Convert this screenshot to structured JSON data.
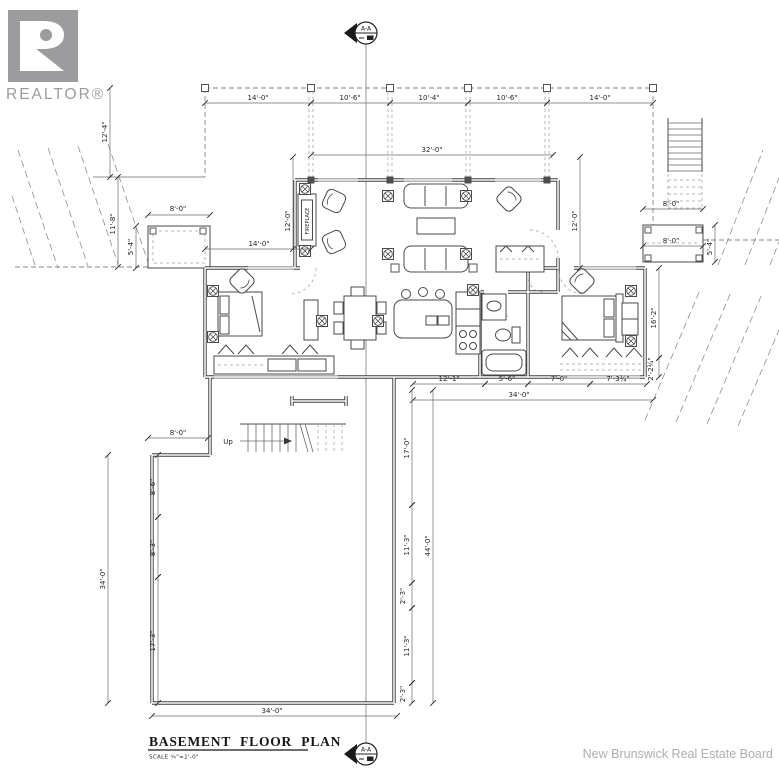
{
  "branding": {
    "realtor_wordmark": "REALTOR®",
    "board_text": "New Brunswick Real Estate Board"
  },
  "title_block": {
    "title": "BASEMENT FLOOR PLAN",
    "scale": "SCALE  ¾\"=1'-0\""
  },
  "section_marker": {
    "label": "A-A"
  },
  "plan_labels": [
    {
      "t": "Up",
      "lx": 228,
      "ly": 444,
      "s": 7
    },
    {
      "t": "FIREPLACE",
      "lx": 309,
      "ly": 221,
      "r": -90,
      "s": 5
    }
  ],
  "dimensions": [
    {
      "t": "14'-0\"",
      "lx": 258,
      "ly": 100,
      "line": [
        205,
        103,
        311,
        103
      ]
    },
    {
      "t": "10'-6\"",
      "lx": 350,
      "ly": 100,
      "line": [
        311,
        103,
        390,
        103
      ]
    },
    {
      "t": "10'-4\"",
      "lx": 429,
      "ly": 100,
      "line": [
        390,
        103,
        468,
        103
      ]
    },
    {
      "t": "10'-6\"",
      "lx": 507,
      "ly": 100,
      "line": [
        468,
        103,
        547,
        103
      ]
    },
    {
      "t": "14'-0\"",
      "lx": 600,
      "ly": 100,
      "line": [
        547,
        103,
        653,
        103
      ]
    },
    {
      "t": "32'-0\"",
      "lx": 432,
      "ly": 152,
      "line": [
        311,
        155,
        553,
        155
      ]
    },
    {
      "t": "12'-4\"",
      "lx": 107,
      "ly": 132,
      "r": -90,
      "line": [
        110,
        88,
        110,
        177
      ]
    },
    {
      "t": "11'-8\"",
      "lx": 115,
      "ly": 224,
      "r": -90,
      "line": [
        118,
        177,
        118,
        267
      ]
    },
    {
      "t": "8'-0\"",
      "lx": 178,
      "ly": 211,
      "line": [
        148,
        215,
        210,
        215
      ]
    },
    {
      "t": "5'-4\"",
      "lx": 133,
      "ly": 247,
      "r": -90,
      "line": [
        136,
        226,
        136,
        268
      ]
    },
    {
      "t": "14'-0\"",
      "lx": 259,
      "ly": 246,
      "line": [
        205,
        249,
        311,
        249
      ]
    },
    {
      "t": "12'-0\"",
      "lx": 290,
      "ly": 221,
      "r": -90,
      "line": [
        293,
        157,
        293,
        249
      ]
    },
    {
      "t": "12'-0\"",
      "lx": 577,
      "ly": 221,
      "r": -90,
      "line": [
        580,
        157,
        580,
        268
      ]
    },
    {
      "t": "8'-0\"",
      "lx": 671,
      "ly": 206,
      "line": [
        643,
        209,
        703,
        209
      ]
    },
    {
      "t": "8'-0\"",
      "lx": 671,
      "ly": 243,
      "line": [
        643,
        246,
        703,
        246
      ]
    },
    {
      "t": "5'-4\"",
      "lx": 712,
      "ly": 247,
      "r": -90,
      "line": [
        715,
        225,
        715,
        262
      ]
    },
    {
      "t": "16'-2\"",
      "lx": 656,
      "ly": 318,
      "r": -90,
      "line": [
        659,
        268,
        659,
        358
      ]
    },
    {
      "t": "2'-2¾\"",
      "lx": 653,
      "ly": 369,
      "r": -90,
      "line": [
        659,
        358,
        659,
        377
      ]
    },
    {
      "t": "12'-1\"",
      "lx": 449,
      "ly": 381,
      "line": [
        413,
        384,
        485,
        384
      ]
    },
    {
      "t": "5'-6\"",
      "lx": 507,
      "ly": 381,
      "line": [
        485,
        384,
        528,
        384
      ]
    },
    {
      "t": "7'-0\"",
      "lx": 559,
      "ly": 381,
      "line": [
        528,
        384,
        590,
        384
      ]
    },
    {
      "t": "7'-3¾\"",
      "lx": 618,
      "ly": 381,
      "line": [
        590,
        384,
        647,
        384
      ]
    },
    {
      "t": "34'-0\"",
      "lx": 519,
      "ly": 397,
      "line": [
        413,
        400,
        653,
        400
      ]
    },
    {
      "t": "8'-0\"",
      "lx": 178,
      "ly": 435,
      "line": [
        148,
        438,
        208,
        438
      ]
    },
    {
      "t": "8'-6\"",
      "lx": 155,
      "ly": 487,
      "r": -90,
      "line": [
        158,
        455,
        158,
        517
      ]
    },
    {
      "t": "8'-3\"",
      "lx": 155,
      "ly": 548,
      "r": -90,
      "line": [
        158,
        517,
        158,
        577
      ]
    },
    {
      "t": "17'-3\"",
      "lx": 155,
      "ly": 641,
      "r": -90,
      "line": [
        158,
        577,
        158,
        703
      ]
    },
    {
      "t": "34'-0\"",
      "lx": 105,
      "ly": 579,
      "r": -90,
      "line": [
        108,
        455,
        108,
        703
      ]
    },
    {
      "t": "17'-0\"",
      "lx": 409,
      "ly": 448,
      "r": -90,
      "line": [
        412,
        390,
        412,
        505
      ]
    },
    {
      "t": "11'-3\"",
      "lx": 409,
      "ly": 545,
      "r": -90,
      "line": [
        412,
        505,
        412,
        583
      ]
    },
    {
      "t": "2'-3\"",
      "lx": 405,
      "ly": 596,
      "r": -90,
      "line": [
        412,
        583,
        412,
        608
      ]
    },
    {
      "t": "11'-3\"",
      "lx": 409,
      "ly": 646,
      "r": -90,
      "line": [
        412,
        608,
        412,
        683
      ]
    },
    {
      "t": "2'-3\"",
      "lx": 405,
      "ly": 694,
      "r": -90,
      "line": [
        412,
        683,
        412,
        703
      ]
    },
    {
      "t": "44'-0\"",
      "lx": 430,
      "ly": 546,
      "r": -90,
      "line": [
        433,
        390,
        433,
        703
      ]
    },
    {
      "t": "34'-0\"",
      "lx": 272,
      "ly": 713,
      "line": [
        152,
        716,
        397,
        716
      ]
    }
  ]
}
